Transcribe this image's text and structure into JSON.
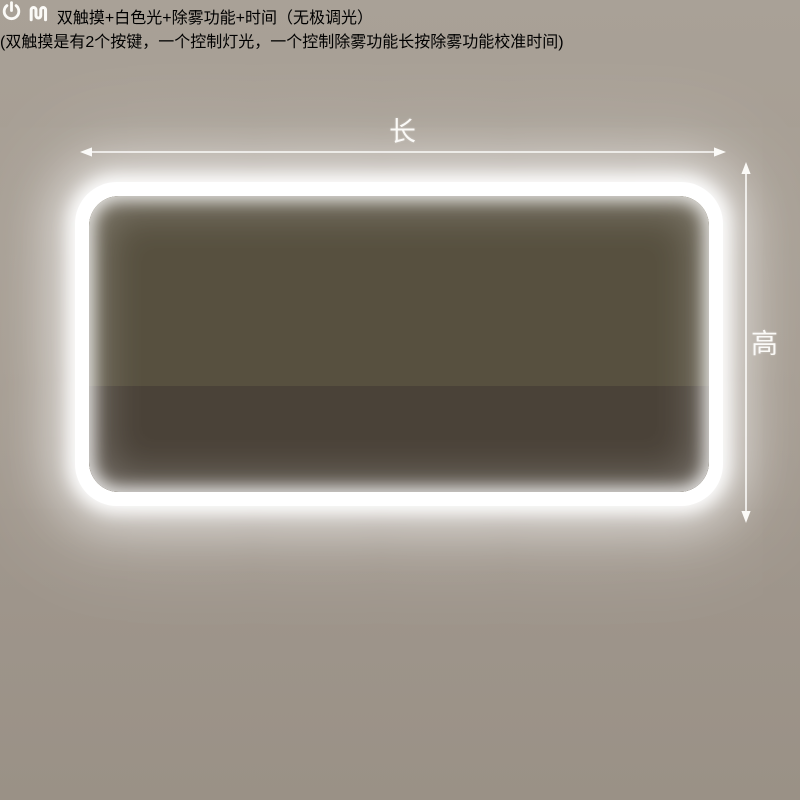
{
  "dimensions": {
    "length_label": "长",
    "height_label": "高"
  },
  "mirror": {
    "clock_time": "15:08",
    "display_icons": [
      "defog-icon",
      "power-icon"
    ]
  },
  "features": {
    "icon_names": [
      "power-icon",
      "defog-icon"
    ],
    "headline": "双触摸+白色光+除雾功能+时间（无极调光）",
    "subline": "(双触摸是有2个按键，一个控制灯光，一个控制除雾功能长按除雾功能校准时间)"
  },
  "colors": {
    "background_top": "#a49b90",
    "background_bottom": "#9a9186",
    "divider": "#f6f4f1",
    "led_white": "#ffffff",
    "wall_beige": "#cfc3aa",
    "rack_dark": "#39322a",
    "bronze": "#8a5f33",
    "text_white": "#fdfdfb"
  }
}
